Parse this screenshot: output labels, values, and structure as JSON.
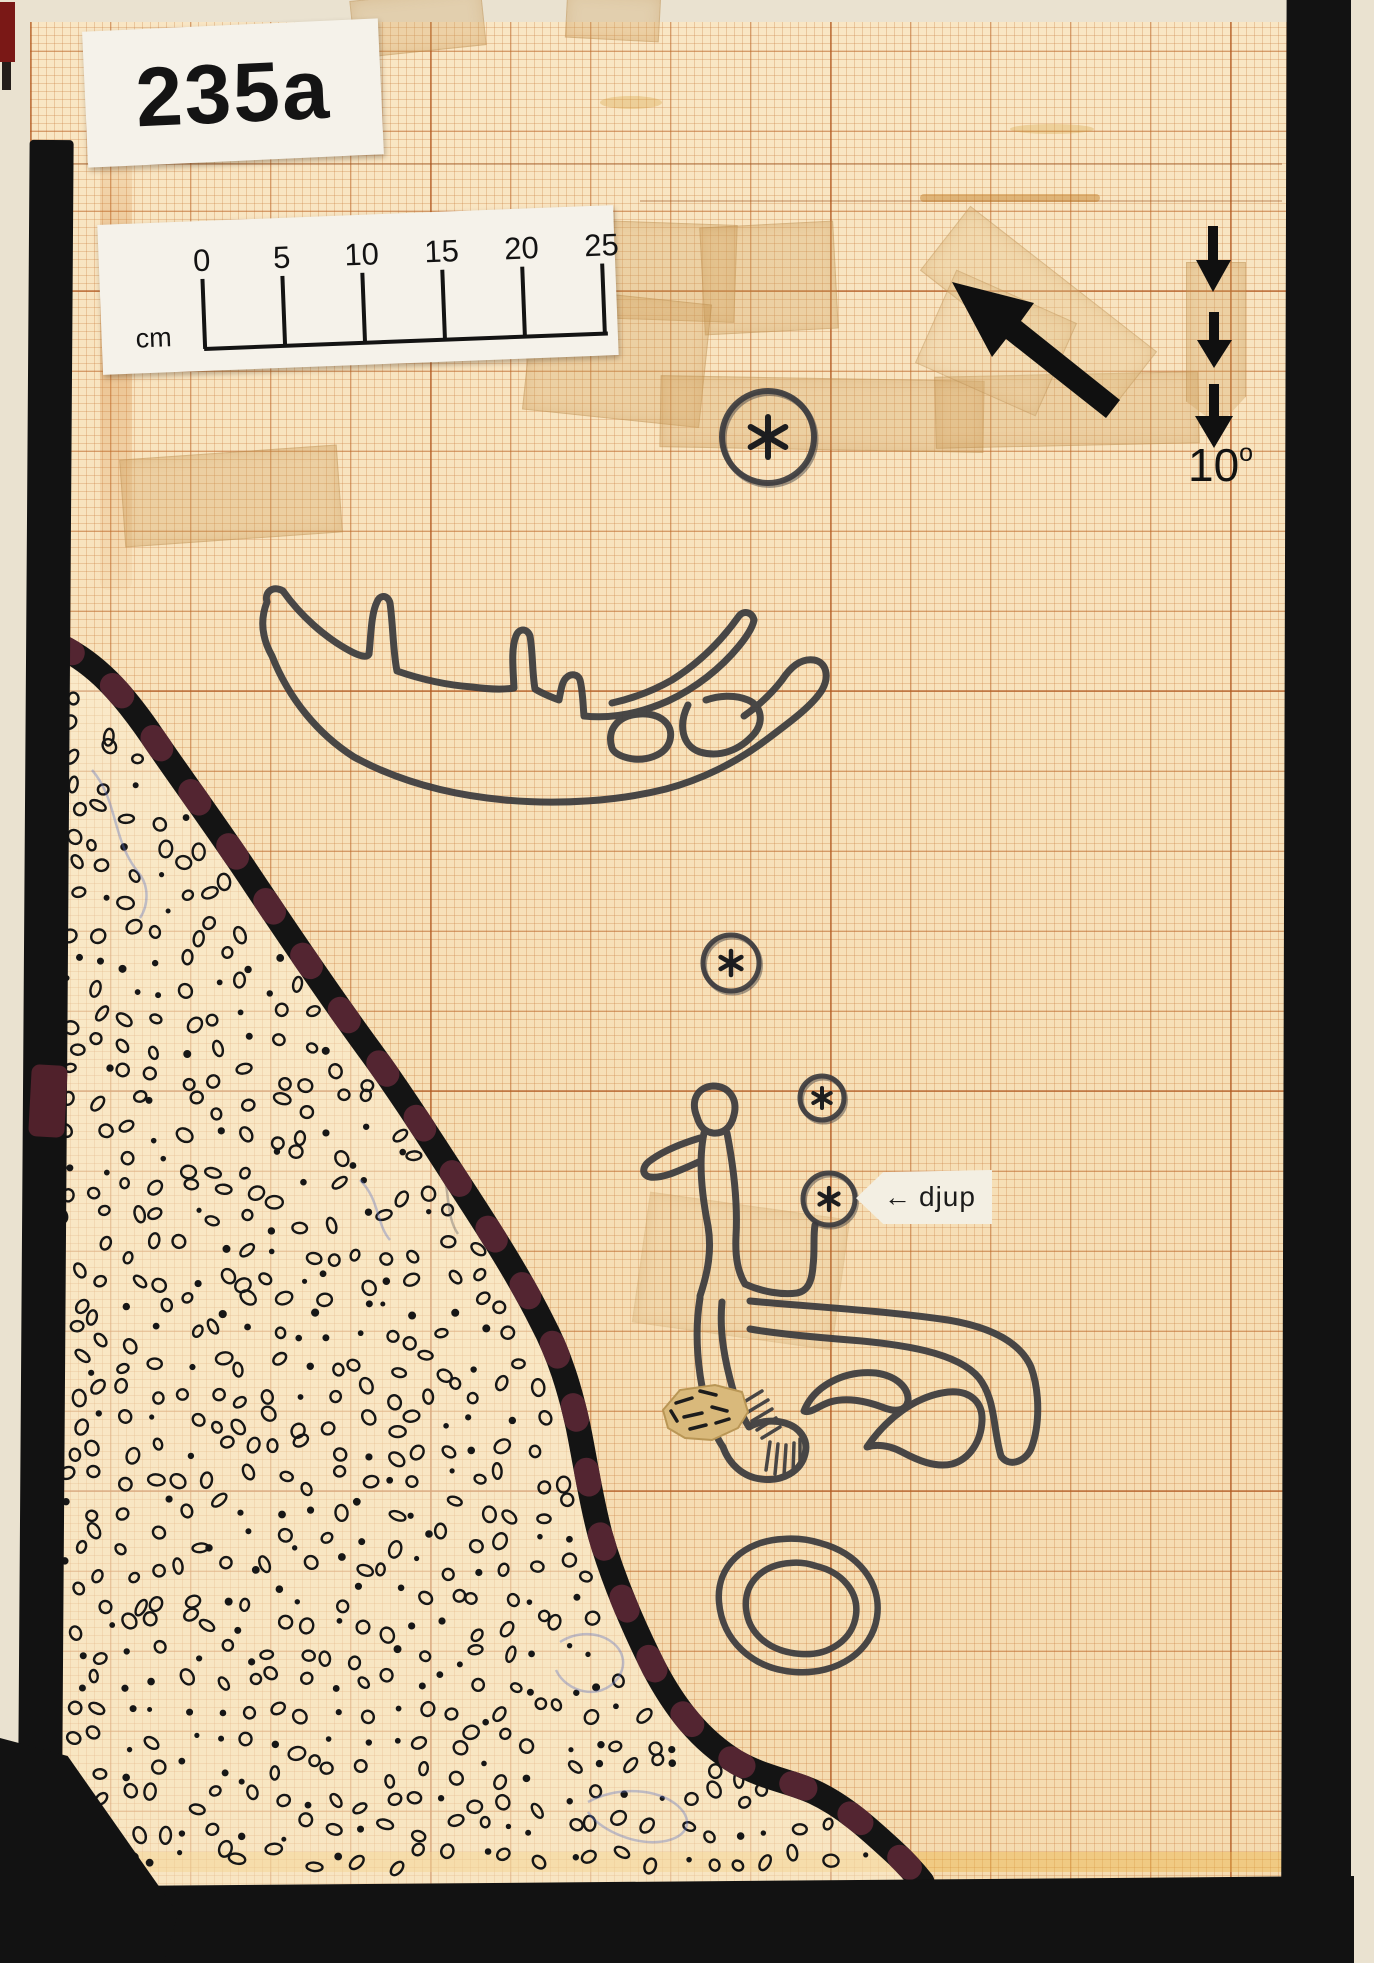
{
  "labels": {
    "plate_id": "235a",
    "declination_value": "10",
    "declination_sup": "o",
    "depth_label": "djup",
    "depth_arrow": "←"
  },
  "scale_bar": {
    "unit": "cm",
    "ticks": [
      "0",
      "5",
      "10",
      "15",
      "20",
      "25"
    ]
  },
  "icons": {
    "direction_arrow": "solid-arrow-up-left",
    "declination_arrow": "triple-dashed-arrow-down",
    "depth_pointer": "left-arrow",
    "cup_mark": "asterisk"
  },
  "palette": {
    "paper": "#f7e1ba",
    "grid_line": "#c9783e",
    "ink": "#3a3a3d",
    "tape_black": "#121212",
    "edge_maroon": "#5e2836",
    "card_white": "#f5f2ea",
    "patch_beige": "#d9b97b",
    "backing": "#eae2d0"
  }
}
